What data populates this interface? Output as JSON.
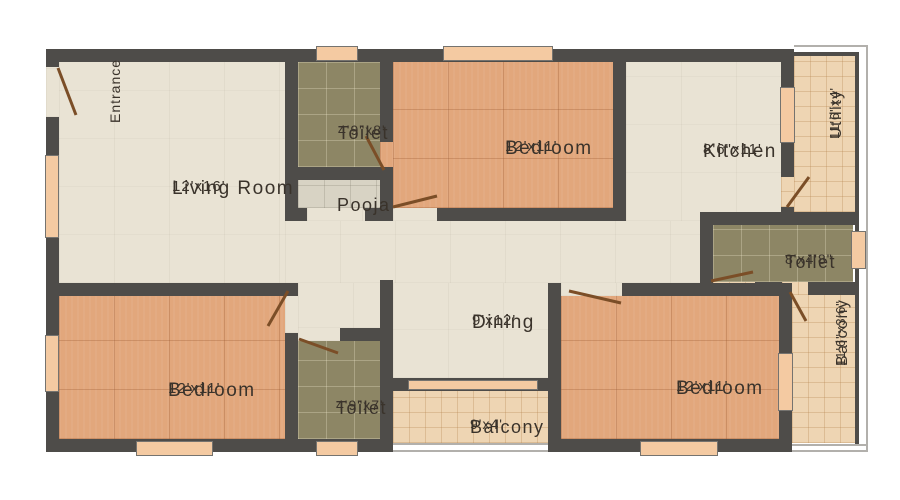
{
  "plan": {
    "entrance_label": "Entrance",
    "rooms": {
      "living": {
        "name": "Living Room",
        "dims": "12'x16'"
      },
      "toilet_top": {
        "name": "Toilet",
        "dims": "4'9\"x8'"
      },
      "pooja": {
        "name": "Pooja"
      },
      "bedroom_top": {
        "name": "Bedroom",
        "dims": "12'x11'"
      },
      "kitchen": {
        "name": "Kitchen",
        "dims": "8'6\"x11'"
      },
      "utility": {
        "name": "Utility",
        "dims": "11'6\"x4'"
      },
      "toilet_right": {
        "name": "Toilet",
        "dims": "8'x4'8\""
      },
      "dining": {
        "name": "Dining",
        "dims": "9'x12'"
      },
      "bedroom_left": {
        "name": "Bedroom",
        "dims": "12'x11'"
      },
      "toilet_bottom": {
        "name": "Toilet",
        "dims": "4'9\"x7'"
      },
      "balcony_bottom": {
        "name": "Balcony",
        "dims": "9'x4'"
      },
      "bedroom_right": {
        "name": "Bedroom",
        "dims": "12'x11'"
      },
      "balcony_right": {
        "name": "Balcony",
        "dims": "11'6\"x3'6\""
      }
    },
    "colors": {
      "wall": "#4e4c49",
      "beige_floor": "#e9e3d4",
      "bedroom_floor": "#e2a77c",
      "toilet_floor": "#8d8665",
      "pooja_floor": "#d8d3c4",
      "balcony_floor": "#eed5b3",
      "window": "#f4caa2",
      "door": "#7b4e27",
      "text": "#3a332b"
    }
  }
}
